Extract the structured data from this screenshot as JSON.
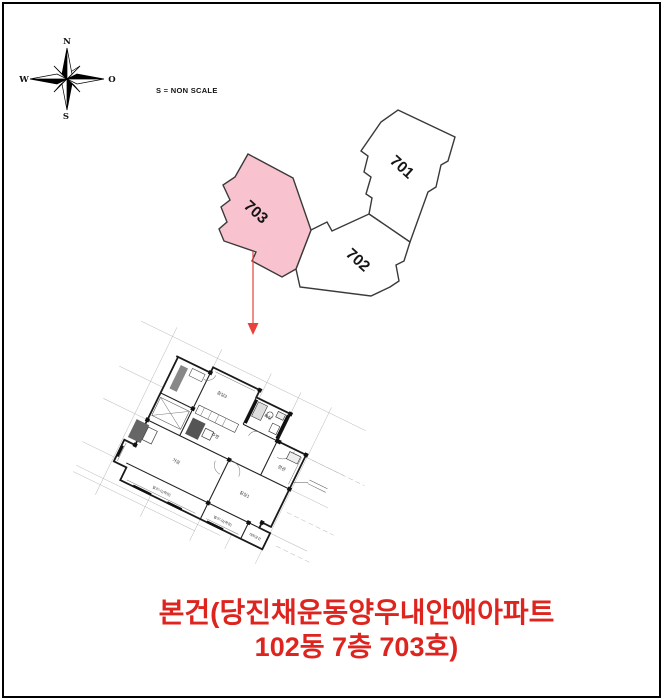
{
  "compass": {
    "north": "N",
    "south": "S",
    "west": "W",
    "east": "O"
  },
  "scale_note": "S = NON SCALE",
  "site_plan": {
    "outline_color": "#3a3a3a",
    "highlight_color": "#f8c3cf",
    "units": [
      {
        "id": "701",
        "label": "701",
        "highlighted": false
      },
      {
        "id": "702",
        "label": "702",
        "highlighted": false
      },
      {
        "id": "703",
        "label": "703",
        "highlighted": true
      }
    ]
  },
  "arrow": {
    "color": "#e8423b"
  },
  "floor_plan": {
    "rooms": [
      {
        "label": "침실3"
      },
      {
        "label": "욕실"
      },
      {
        "label": "주방"
      },
      {
        "label": "현관"
      },
      {
        "label": "거실"
      },
      {
        "label": "침실1"
      },
      {
        "label": "발코니1(확장)"
      },
      {
        "label": "발코니2(확장)"
      },
      {
        "label": "대피공간"
      }
    ]
  },
  "caption": {
    "color": "#de241e",
    "line1": "본건(당진채운동양우내안애아파트",
    "line2": "102동 7층 703호)"
  }
}
